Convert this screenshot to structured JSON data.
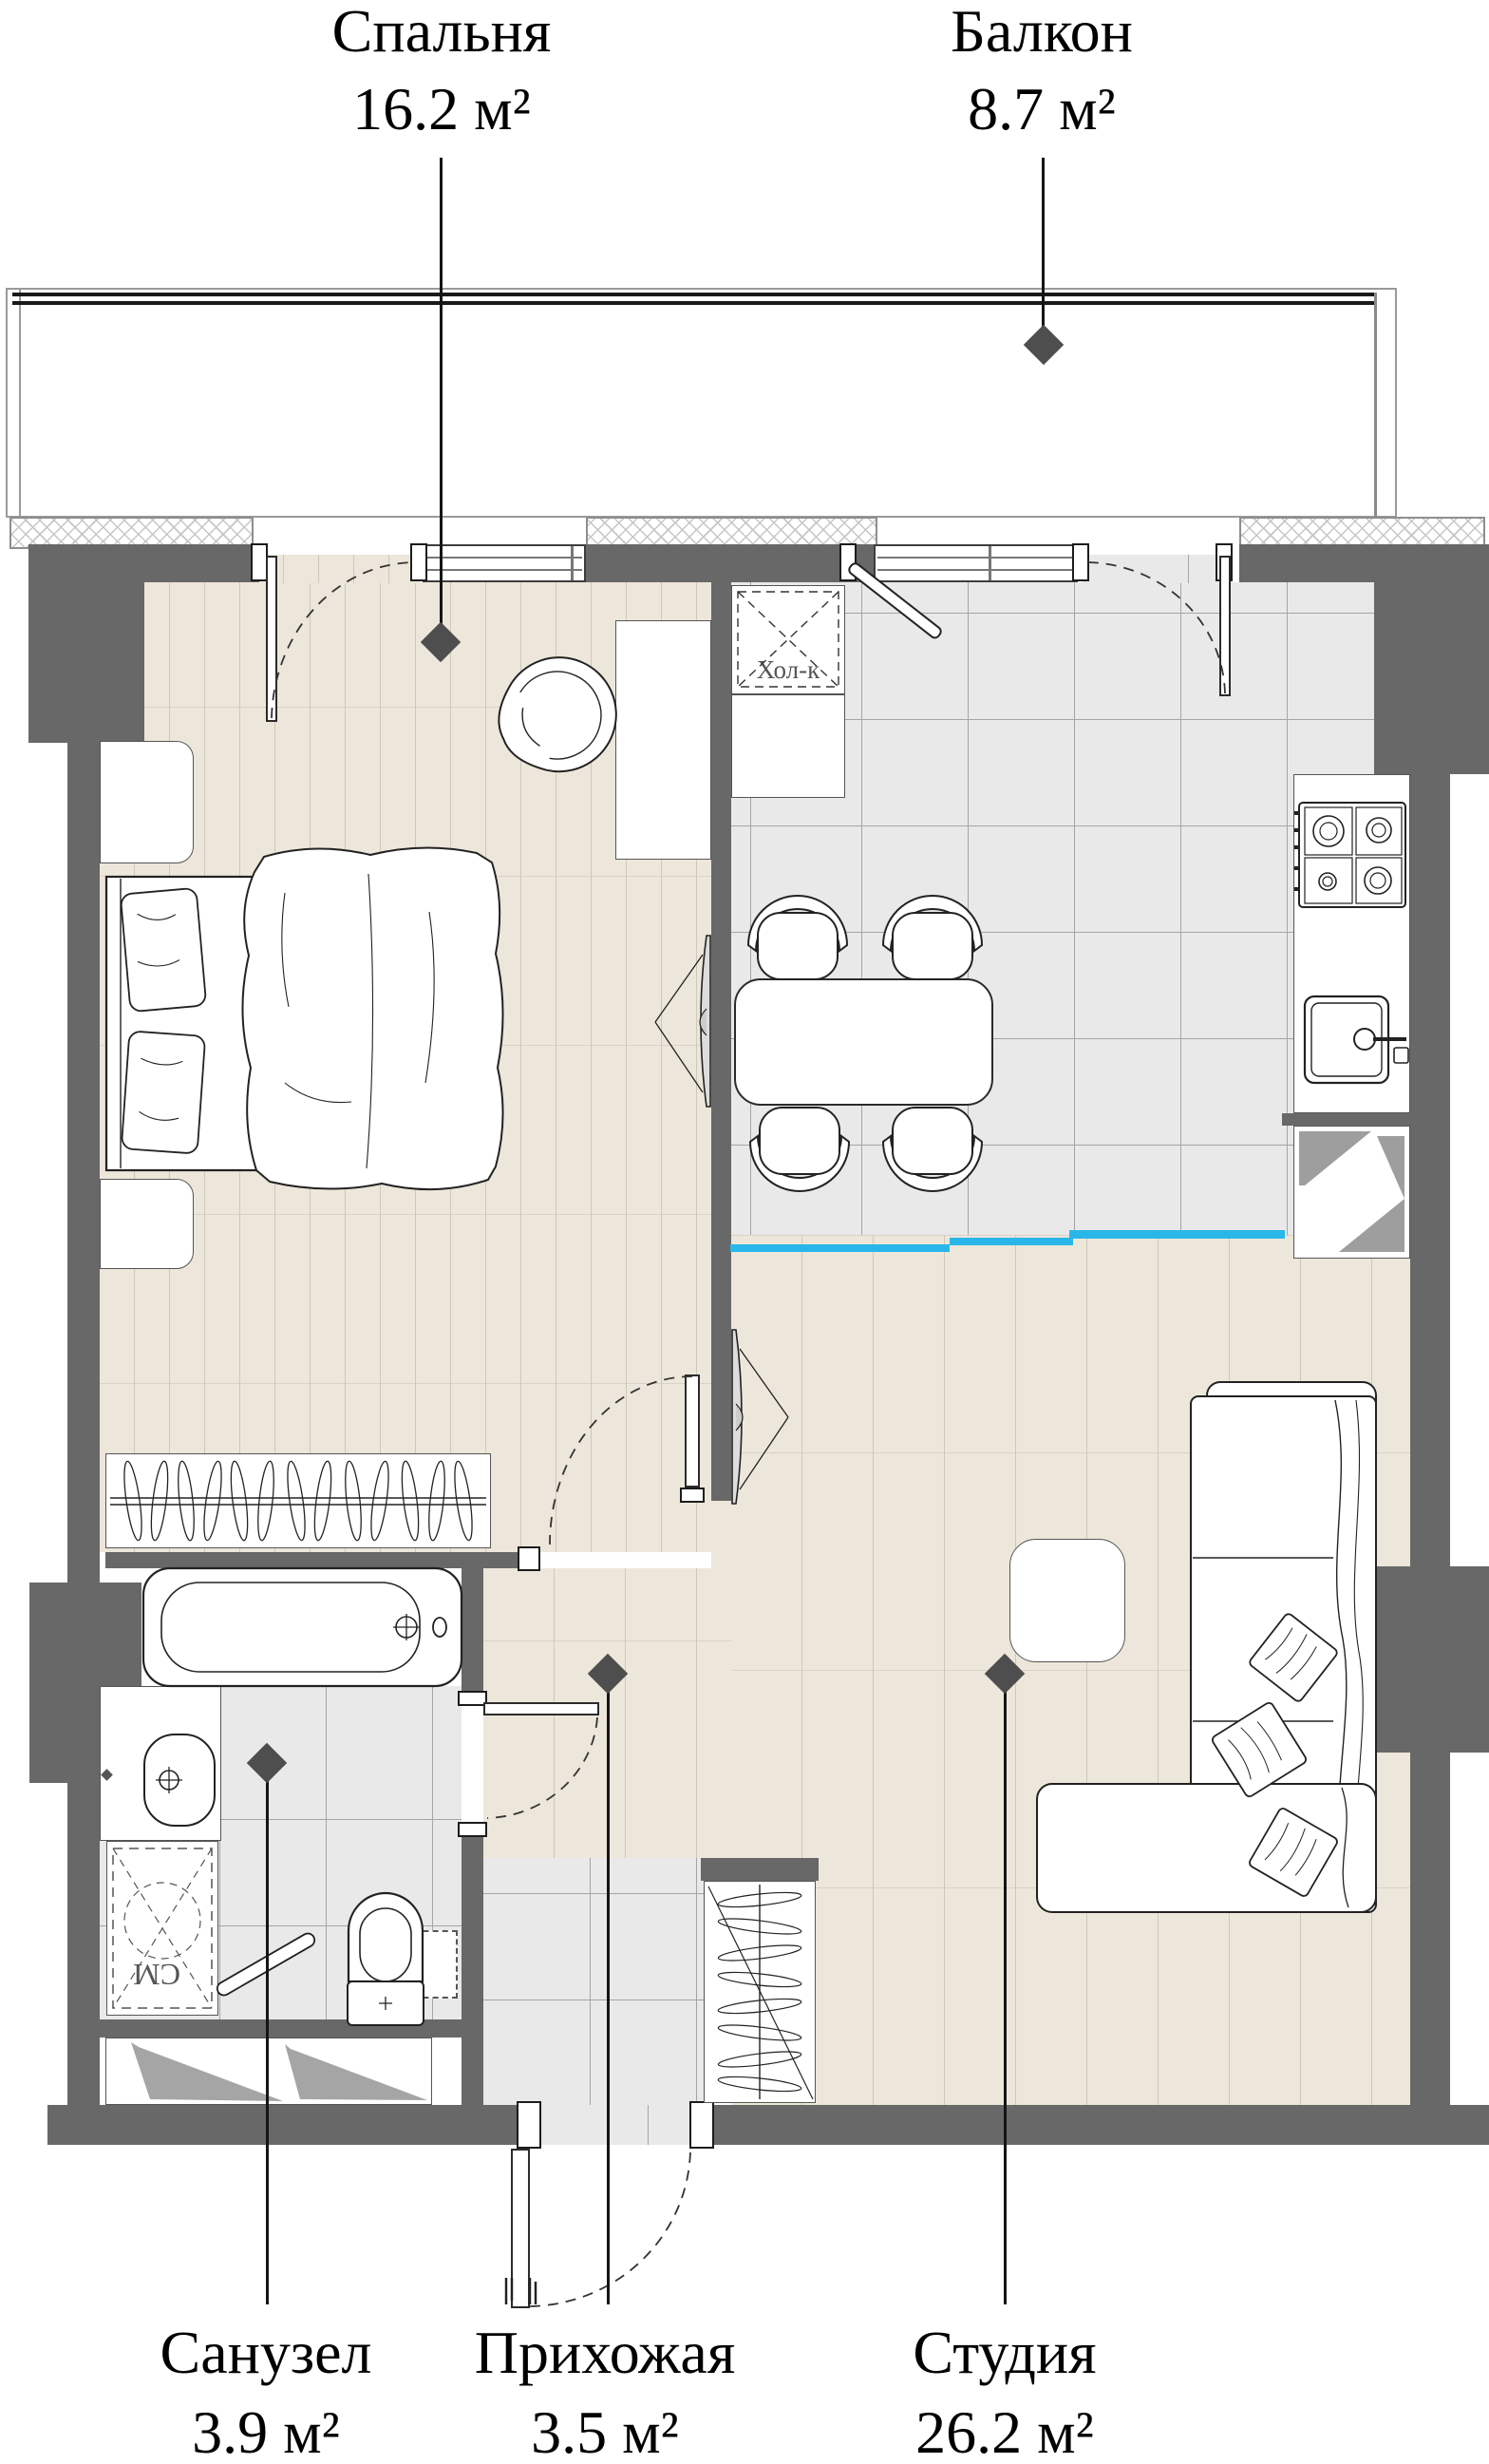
{
  "plan_title": "studio apartment floor plan",
  "rooms": [
    {
      "id": "bedroom",
      "name": "Спальня",
      "area": "16.2 м²"
    },
    {
      "id": "balcony",
      "name": "Балкон",
      "area": "8.7 м²"
    },
    {
      "id": "bathroom",
      "name": "Санузел",
      "area": "3.9 м²"
    },
    {
      "id": "hallway",
      "name": "Прихожая",
      "area": "3.5 м²"
    },
    {
      "id": "studio",
      "name": "Студия",
      "area": "26.2 м²"
    }
  ],
  "annotations": {
    "fridge": "Хол-к",
    "washer": "СМ"
  },
  "colors": {
    "wall": "#686868",
    "partition_accent": "#29b7ea",
    "wood_floor": "#ede6da",
    "tile_floor": "#e9e9e9",
    "marker": "#4e4e4e"
  }
}
